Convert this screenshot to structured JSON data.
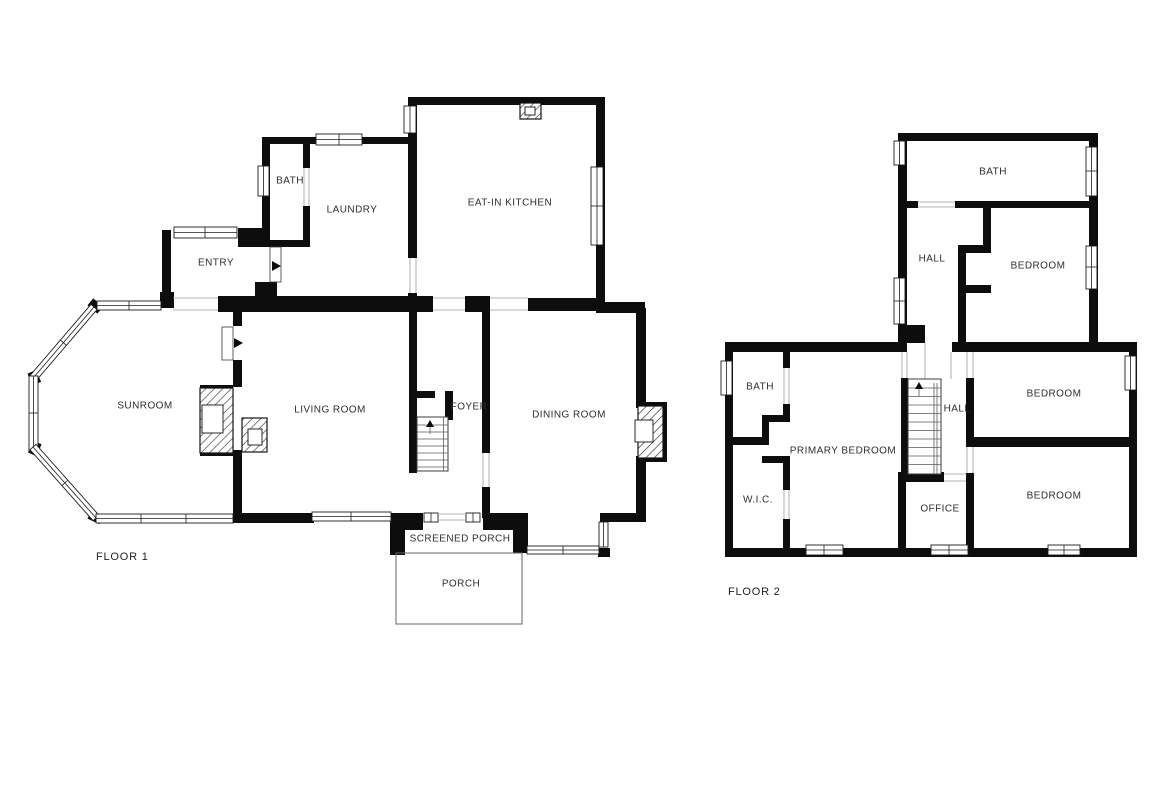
{
  "floors": [
    {
      "title": "FLOOR 1",
      "rooms": [
        {
          "key": "bath",
          "label": "BATH"
        },
        {
          "key": "laundry",
          "label": "LAUNDRY"
        },
        {
          "key": "eat-in-kitchen",
          "label": "EAT-IN KITCHEN"
        },
        {
          "key": "entry",
          "label": "ENTRY"
        },
        {
          "key": "sunroom",
          "label": "SUNROOM"
        },
        {
          "key": "living-room",
          "label": "LIVING ROOM"
        },
        {
          "key": "foyer",
          "label": "FOYER"
        },
        {
          "key": "dining-room",
          "label": "DINING ROOM"
        },
        {
          "key": "screened-porch",
          "label": "SCREENED PORCH"
        },
        {
          "key": "porch",
          "label": "PORCH"
        }
      ]
    },
    {
      "title": "FLOOR 2",
      "rooms": [
        {
          "key": "bath-upper",
          "label": "BATH"
        },
        {
          "key": "hall-upper",
          "label": "HALL"
        },
        {
          "key": "bedroom-upper",
          "label": "BEDROOM"
        },
        {
          "key": "bath-lower",
          "label": "BATH"
        },
        {
          "key": "primary-bedroom",
          "label": "PRIMARY BEDROOM"
        },
        {
          "key": "hall-lower",
          "label": "HALL"
        },
        {
          "key": "bedroom-ne",
          "label": "BEDROOM"
        },
        {
          "key": "wic",
          "label": "W.I.C."
        },
        {
          "key": "office",
          "label": "OFFICE"
        },
        {
          "key": "bedroom-se",
          "label": "BEDROOM"
        }
      ]
    }
  ],
  "symbols": {
    "stairs_up_arrow": "up-arrow",
    "door_swing_arrow": "right-arrow"
  },
  "colors": {
    "wall": "#0d0d0d",
    "hatch_line": "#333333",
    "window_line": "#1c1c1c",
    "text": "#2e2e2e",
    "background": "#ffffff"
  }
}
